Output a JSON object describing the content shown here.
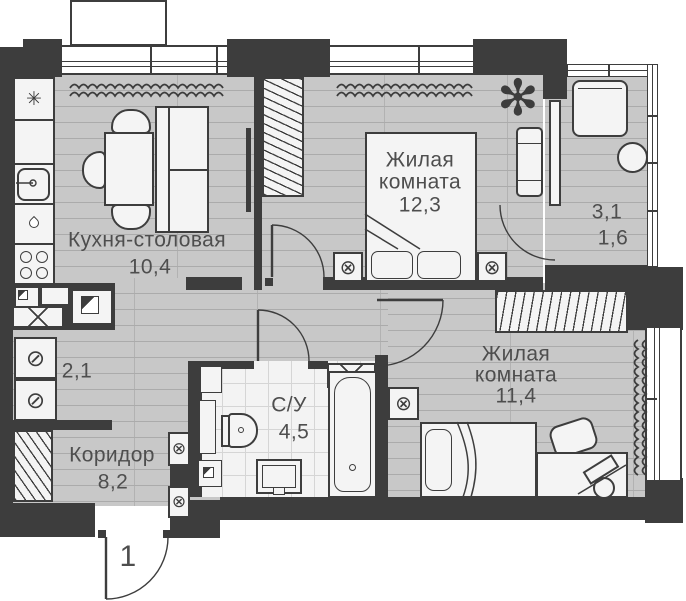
{
  "rooms": {
    "kitchen": {
      "name": "Кухня-столовая",
      "area": "10,4"
    },
    "living_a": {
      "name_line1": "Жилая",
      "name_line2": "комната",
      "area": "12,3"
    },
    "living_b": {
      "name_line1": "Жилая",
      "name_line2": "комната",
      "area": "11,4"
    },
    "balcony": {
      "area_total": "3,1",
      "area_reduced": "1,6"
    },
    "utility": {
      "area": "2,1"
    },
    "corridor": {
      "name": "Коридор",
      "area": "8,2"
    },
    "bathroom": {
      "name": "С/У",
      "area": "4,5"
    }
  },
  "entrance": {
    "door_number": "1"
  },
  "icons": {
    "fridge_snowflake": "✳",
    "washing_machine": "⊘",
    "light_fixture": "⊗",
    "plant": "✻"
  },
  "colors": {
    "wall": "#3d3d3d",
    "floor": "#c8c8c8",
    "floor_line": "#ababab",
    "fixture_fill": "#f4f4f4",
    "text": "#4e4e4e"
  }
}
